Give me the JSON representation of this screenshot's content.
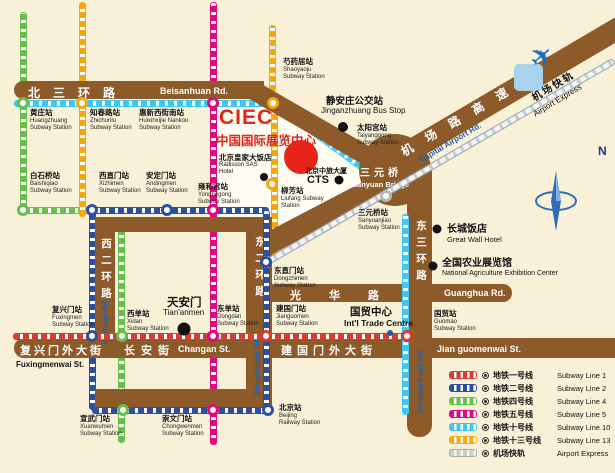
{
  "ciec": {
    "abbr": "CIEC",
    "name_zh": "中国国际展览中心"
  },
  "compass": {
    "n": "N"
  },
  "icons": {
    "plane": "✈",
    "legend_station": "circled-dot-icon"
  },
  "colors": {
    "background": "#f8f1d8",
    "road": "#8d5a2a",
    "ciec_red": "#e0251b",
    "road_label_blue": "#1e5fae"
  },
  "roads": {
    "beisanhuan_zh": "北三环路",
    "beisanhuan_en": "Beisanhuan Rd.",
    "airport_zh": "机 场 路 高 速",
    "airport_en": "Capital Airport Rd.",
    "xierhuan_zh": "西二环路",
    "xierhuan_en": "Xierhuan Rd.",
    "dongerhuan_zh": "东二环路",
    "dongerhuan_en": "Dongerhuan Rd.",
    "dongsanhuan_zh": "东三环路",
    "dongsanhuan_en": "Dongsanhuan Rd.",
    "guanghua_zh": "光华路",
    "guanghua_en": "Guanghua Rd.",
    "fuxingmenwai_zh": "复兴门外大街",
    "fuxingmenwai_en": "Fuxingmenwai St.",
    "changan_zh": "长安街",
    "changan_en": "Changan St.",
    "jianguomenwai_zh": "建国门外大街",
    "jianguomenwai_en": "Jian guomenwai St.",
    "sanyuan_zh": "三元桥",
    "sanyuan_en": "Sanyuan Bridge",
    "airport_line_zh": "机场快轨",
    "airport_line_en": "Airport Express"
  },
  "line_colors": {
    "red": "#d93a32",
    "blue": "#2b50a1",
    "green": "#67bf4e",
    "magenta": "#e2087e",
    "cyan": "#3fc6f2",
    "orange": "#f6a70b",
    "gray": "#b3b8b2"
  },
  "stations": [
    {
      "id": "huangzhuang",
      "x": 23,
      "y": 103,
      "c": "green",
      "lx": 30,
      "ly": 109,
      "zh": "黄庄站",
      "en": [
        "Huangzhuang",
        "Subway Station"
      ]
    },
    {
      "id": "zhichunlu",
      "x": 82,
      "y": 103,
      "c": "orange",
      "lx": 90,
      "ly": 109,
      "zh": "知春路站",
      "en": [
        "Zhichunlu",
        "Subway Station"
      ]
    },
    {
      "id": "huixinxijie-nankou",
      "x": 213,
      "y": 103,
      "c": "magenta",
      "lx": 139,
      "ly": 109,
      "zh": "惠新西街南站",
      "en": [
        "Huixinxijie Nankou",
        "Subway Station"
      ]
    },
    {
      "id": "shaoyaoju",
      "x": 273,
      "y": 103,
      "c": "orange",
      "lx": 283,
      "ly": 58,
      "zh": "芍药居站",
      "en": [
        "Shaoyaoju",
        "Subway Station"
      ]
    },
    {
      "id": "baishiqiao",
      "x": 23,
      "y": 210,
      "c": "green",
      "lx": 30,
      "ly": 172,
      "zh": "白石桥站",
      "en": [
        "Baishiqiao",
        "Subway Station"
      ]
    },
    {
      "id": "xizhimen",
      "x": 92,
      "y": 210,
      "c": "blue",
      "lx": 99,
      "ly": 172,
      "zh": "西直门站",
      "en": [
        "Xizhimen",
        "Subway Station"
      ]
    },
    {
      "id": "andingmen",
      "x": 167,
      "y": 210,
      "c": "blue",
      "lx": 146,
      "ly": 172,
      "zh": "安定门站",
      "en": [
        "Andingmen",
        "Subway Station"
      ]
    },
    {
      "id": "yonghegong",
      "x": 213,
      "y": 210,
      "c": "magenta",
      "lx": 198,
      "ly": 183,
      "zh": "雍和宫站",
      "en": [
        "Yonghegong",
        "Subway Station"
      ]
    },
    {
      "id": "liufang",
      "x": 272,
      "y": 184,
      "c": "orange",
      "lx": 281,
      "ly": 187,
      "zh": "柳芳站",
      "en": [
        "Liufang Subway",
        "Station"
      ]
    },
    {
      "id": "taiyanggong",
      "nocircle": true,
      "lx": 357,
      "ly": 124,
      "zh": "太阳宫站",
      "en": [
        "Taiyanggong",
        "Subway Station"
      ]
    },
    {
      "id": "sanyuanqiao",
      "x": 386,
      "y": 196,
      "c": "gray",
      "lx": 358,
      "ly": 209,
      "zh": "三元桥站",
      "en": [
        "Sanyuanjiao",
        "Subway Station"
      ]
    },
    {
      "id": "dongzhimen",
      "x": 266,
      "y": 262,
      "c": "blue",
      "lx": 274,
      "ly": 267,
      "zh": "东直门站",
      "en": [
        "Dongzhimen",
        "Subway Station"
      ]
    },
    {
      "id": "fuxingmen",
      "x": 92,
      "y": 336,
      "c": "blue",
      "lx": 52,
      "ly": 306,
      "zh": "复兴门站",
      "en": [
        "Fuxingmen",
        "Subway Station"
      ]
    },
    {
      "id": "xidan",
      "x": 122,
      "y": 336,
      "c": "green",
      "lx": 127,
      "ly": 310,
      "zh": "西单站",
      "en": [
        "Xidan",
        "Subway Station"
      ]
    },
    {
      "id": "dongdan",
      "x": 213,
      "y": 336,
      "c": "magenta",
      "lx": 217,
      "ly": 305,
      "zh": "东单站",
      "en": [
        "Dongdan",
        "Subway Station"
      ]
    },
    {
      "id": "jianguomen",
      "x": 266,
      "y": 336,
      "c": "red",
      "lx": 276,
      "ly": 305,
      "zh": "建国门站",
      "en": [
        "Jianguomen",
        "Subway Station"
      ]
    },
    {
      "id": "guomao",
      "x": 407,
      "y": 336,
      "c": "red",
      "lx": 434,
      "ly": 310,
      "zh": "国贸站",
      "en": [
        "Guomao",
        "Subway Station"
      ]
    },
    {
      "id": "xuanwumen",
      "x": 123,
      "y": 410,
      "c": "green",
      "lx": 80,
      "ly": 415,
      "zh": "宣武门站",
      "en": [
        "Xuanwumen",
        "Subway Station"
      ]
    },
    {
      "id": "chongwenmen",
      "x": 213,
      "y": 410,
      "c": "magenta",
      "lx": 162,
      "ly": 415,
      "zh": "崇文门站",
      "en": [
        "Chongwenmen",
        "Subway Station"
      ]
    },
    {
      "id": "beijing-railway",
      "x": 268,
      "y": 410,
      "c": "blue",
      "lx": 279,
      "ly": 404,
      "zh": "北京站",
      "en": [
        "Beijing",
        "Railway Station"
      ]
    }
  ],
  "pois": [
    {
      "id": "jinganzhuang-bus-stop",
      "dx": 343,
      "dy": 127,
      "r": 10,
      "lx": 326,
      "ly": 93,
      "ex": 321,
      "ey": 106,
      "zh": "静安庄公交站",
      "en": "Jinganzhuang Bus Stop",
      "style": "jgz"
    },
    {
      "id": "radisson-sas-hotel",
      "dx": 264,
      "dy": 177,
      "r": 8,
      "lx": 219,
      "ly": 152,
      "ex": 219,
      "ey": 162,
      "zh": "北京皇家大饭店",
      "en": "Radisson SAS Hotel",
      "style": "small"
    },
    {
      "id": "cts-tower",
      "dx": 339,
      "dy": 180,
      "r": 9,
      "lx": 305,
      "ly": 166,
      "ex": 307,
      "ey": 174,
      "zh": "北京中旅大厦",
      "en": "CTS",
      "style": "cts"
    },
    {
      "id": "great-wall-hotel",
      "dx": 437,
      "dy": 229,
      "r": 9,
      "lx": 447,
      "ly": 220,
      "ex": 447,
      "ey": 235,
      "zh": "长城饭店",
      "en": "Great Wall Hotel"
    },
    {
      "id": "agriculture-exhibition-center",
      "dx": 433,
      "dy": 266,
      "r": 9,
      "lx": 442,
      "ly": 254,
      "ex": 442,
      "ey": 270,
      "zh": "全国农业展览馆",
      "en": "National Agriculture Exhibition Center",
      "style": "agri"
    },
    {
      "id": "tiananmen",
      "dx": 184,
      "dy": 329,
      "r": 13,
      "lx": 167,
      "ly": 294,
      "ex": 163,
      "ey": 308,
      "zh": "天安门",
      "en": "Tian'anmen",
      "style": "tam"
    },
    {
      "id": "intl-trade-centre",
      "dx": 390,
      "dy": 333,
      "r": 6,
      "lx": 350,
      "ly": 304,
      "ex": 344,
      "ey": 318,
      "zh": "国贸中心",
      "en": "Int'l Trade Centre",
      "style": "itc",
      "dotcolor": "#1b5fa8"
    }
  ],
  "legend": {
    "items": [
      {
        "id": "line-1",
        "color": "#d93a32",
        "zh": "地铁一号线",
        "en": "Subway Line 1"
      },
      {
        "id": "line-2",
        "color": "#2b50a1",
        "zh": "地铁二号线",
        "en": "Subway Line 2"
      },
      {
        "id": "line-4",
        "color": "#67bf4e",
        "zh": "地铁四号线",
        "en": "Subway Line 4"
      },
      {
        "id": "line-5",
        "color": "#e2087e",
        "zh": "地铁五号线",
        "en": "Subway Line 5"
      },
      {
        "id": "line-10",
        "color": "#3fc6f2",
        "zh": "地铁十号线",
        "en": "Subway Line 10"
      },
      {
        "id": "line-13",
        "color": "#f6a70b",
        "zh": "地铁十三号线",
        "en": "Subway Line 13"
      },
      {
        "id": "airport-express",
        "color": "#f4f5ee",
        "border": "#a7aba3",
        "dash": "#cdd0c6",
        "zh": "机场快轨",
        "en": "Airport Express"
      }
    ]
  }
}
